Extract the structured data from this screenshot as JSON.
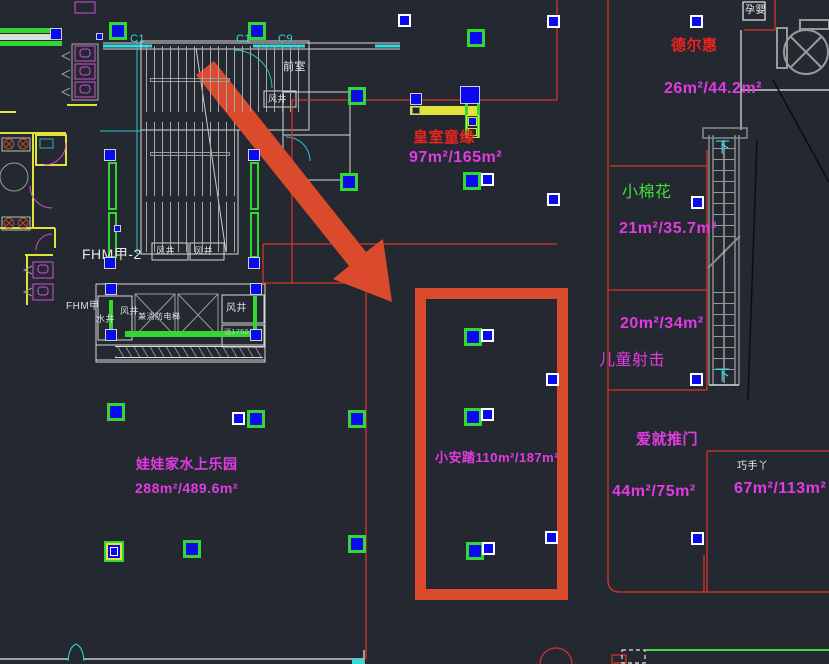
{
  "canvas": {
    "bg": "#232831",
    "width": 829,
    "height": 664
  },
  "palette": {
    "magenta": "#e13ce1",
    "red_text": "#ea241e",
    "green_text": "#3fdf3f",
    "cyan": "#35dcdc",
    "white": "#e8e8e8",
    "blue_marker": "#0a0af0",
    "green_marker": "#32d732",
    "highlight_orange": "#dc4a2e",
    "cad_red_line": "#d5352a",
    "yellow": "#e2e23c"
  },
  "stores": [
    {
      "name": "皇室童缘",
      "area": "97m²/165m²"
    },
    {
      "name": "德尔惠",
      "area": "26m²/44.2m²"
    },
    {
      "name": "小棉花",
      "area": "21m²/35.7m²"
    },
    {
      "name": "未命名铺位",
      "area": "20m²/34m²"
    },
    {
      "name": "儿童射击",
      "area": ""
    },
    {
      "name": "爱就推门",
      "area": "44m²/75m²"
    },
    {
      "name": "巧手丫",
      "area": "67m²/113m²"
    },
    {
      "name": "小安踏",
      "area": "110m²/187m²"
    },
    {
      "name": "娃娃家水上乐园",
      "area": "288m²/489.6m²"
    }
  ],
  "texts": [
    {
      "id": "front-room-label",
      "text": "前室",
      "x": 283,
      "y": 62,
      "s": 11,
      "c": "#e8e8e8"
    },
    {
      "id": "grid-c1-a",
      "text": "C1",
      "x": 130,
      "y": 34,
      "s": 11,
      "c": "#35dcdc"
    },
    {
      "id": "grid-c1-b",
      "text": "C1",
      "x": 236,
      "y": 34,
      "s": 11,
      "c": "#35dcdc"
    },
    {
      "id": "grid-c9",
      "text": "C9",
      "x": 278,
      "y": 34,
      "s": 11,
      "c": "#35dcdc"
    },
    {
      "id": "shaft-wind-top",
      "text": "风井",
      "x": 268,
      "y": 95,
      "s": 9,
      "c": "#dddddd"
    },
    {
      "id": "stair-tag-fhm",
      "text": "FHM甲-2",
      "x": 82,
      "y": 247,
      "s": 14,
      "c": "#e8e8e8"
    },
    {
      "id": "shaft-wind-1",
      "text": "风井",
      "x": 156,
      "y": 247,
      "s": 9,
      "c": "#dddddd"
    },
    {
      "id": "shaft-wind-2",
      "text": "风井",
      "x": 194,
      "y": 247,
      "s": 9,
      "c": "#dddddd"
    },
    {
      "id": "elevator-tag-fhm",
      "text": "FHM甲",
      "x": 66,
      "y": 302,
      "s": 10,
      "c": "#dddddd"
    },
    {
      "id": "shaft-water",
      "text": "水井",
      "x": 96,
      "y": 315,
      "s": 9,
      "c": "#dddddd"
    },
    {
      "id": "shaft-wind-3",
      "text": "风井",
      "x": 120,
      "y": 307,
      "s": 9,
      "c": "#dddddd"
    },
    {
      "id": "fire-elevator-label",
      "text": "兼消防电梯",
      "x": 138,
      "y": 313,
      "s": 8,
      "c": "#dddddd"
    },
    {
      "id": "shaft-wind-4",
      "text": "风井",
      "x": 226,
      "y": 304,
      "s": 10,
      "c": "#dddddd"
    },
    {
      "id": "fire-hydrant-note",
      "text": "消1750",
      "x": 224,
      "y": 329,
      "s": 7,
      "c": "#cccccc"
    },
    {
      "id": "store-name-huangshi",
      "text": "皇室童缘",
      "x": 413,
      "y": 130,
      "s": 15,
      "c": "#ea241e",
      "b": 1
    },
    {
      "id": "store-area-huangshi",
      "text": "97m²/165m²",
      "x": 409,
      "y": 150,
      "s": 16,
      "c": "#e13ce1",
      "b": 1
    },
    {
      "id": "infant-zone-label",
      "text": "孕婴",
      "x": 745,
      "y": 6,
      "s": 10,
      "c": "#eeeeee"
    },
    {
      "id": "store-name-deerhui",
      "text": "德尔惠",
      "x": 671,
      "y": 38,
      "s": 15,
      "c": "#ea241e",
      "b": 1
    },
    {
      "id": "store-area-deerhui",
      "text": "26m²/44.2m²",
      "x": 664,
      "y": 81,
      "s": 16,
      "c": "#e13ce1",
      "b": 1
    },
    {
      "id": "store-name-xiaomianhua",
      "text": "小棉花",
      "x": 622,
      "y": 185,
      "s": 16,
      "c": "#3fdf3f"
    },
    {
      "id": "store-area-xiaomianhua",
      "text": "21m²/35.7m²",
      "x": 619,
      "y": 221,
      "s": 16,
      "c": "#e13ce1",
      "b": 1
    },
    {
      "id": "store-area-2034",
      "text": "20m²/34m²",
      "x": 620,
      "y": 316,
      "s": 16,
      "c": "#e13ce1",
      "b": 1
    },
    {
      "id": "store-name-ertongsheji",
      "text": "儿童射击",
      "x": 599,
      "y": 353,
      "s": 16,
      "c": "#e13ce1"
    },
    {
      "id": "escalator-down-top",
      "text": "下",
      "x": 715,
      "y": 140,
      "s": 15,
      "c": "#35dcdc"
    },
    {
      "id": "escalator-down-bottom",
      "text": "下",
      "x": 715,
      "y": 368,
      "s": 15,
      "c": "#35dcdc"
    },
    {
      "id": "store-name-aijiutuimen",
      "text": "爱就推门",
      "x": 636,
      "y": 432,
      "s": 15,
      "c": "#e13ce1",
      "b": 1
    },
    {
      "id": "store-area-aijiutuimen",
      "text": "44m²/75m²",
      "x": 612,
      "y": 484,
      "s": 16,
      "c": "#e13ce1",
      "b": 1
    },
    {
      "id": "store-name-qiaoshouya",
      "text": "巧手丫",
      "x": 737,
      "y": 462,
      "s": 10,
      "c": "#eeeeee"
    },
    {
      "id": "store-area-qiaoshouya",
      "text": "67m²/113m²",
      "x": 734,
      "y": 481,
      "s": 16,
      "c": "#e13ce1",
      "b": 1
    },
    {
      "id": "store-label-xiaoanta",
      "text": "小安踏110m²/187m²",
      "x": 435,
      "y": 451,
      "s": 13,
      "c": "#e13ce1",
      "b": 1
    },
    {
      "id": "store-name-wawajia",
      "text": "娃娃家水上乐园",
      "x": 136,
      "y": 457,
      "s": 14,
      "c": "#e13ce1",
      "b": 1
    },
    {
      "id": "store-area-wawajia",
      "text": "288m²/489.6m²",
      "x": 135,
      "y": 481,
      "s": 14,
      "c": "#e13ce1",
      "b": 1
    }
  ],
  "markers": [
    {
      "t": "g",
      "x": 109,
      "y": 22
    },
    {
      "t": "g",
      "x": 248,
      "y": 22
    },
    {
      "t": "g",
      "x": 348,
      "y": 87
    },
    {
      "t": "g",
      "x": 467,
      "y": 29
    },
    {
      "t": "g",
      "x": 340,
      "y": 173
    },
    {
      "t": "g",
      "x": 463,
      "y": 172
    },
    {
      "t": "g",
      "x": 247,
      "y": 410
    },
    {
      "t": "g",
      "x": 348,
      "y": 410
    },
    {
      "t": "g",
      "x": 107,
      "y": 403
    },
    {
      "t": "g",
      "x": 183,
      "y": 540
    },
    {
      "t": "g",
      "x": 348,
      "y": 535
    },
    {
      "t": "g",
      "x": 464,
      "y": 328
    },
    {
      "t": "g",
      "x": 464,
      "y": 408
    },
    {
      "t": "g",
      "x": 466,
      "y": 542
    },
    {
      "t": "w",
      "x": 398,
      "y": 14
    },
    {
      "t": "w",
      "x": 547,
      "y": 15
    },
    {
      "t": "w",
      "x": 690,
      "y": 15
    },
    {
      "t": "w",
      "x": 481,
      "y": 173
    },
    {
      "t": "w",
      "x": 547,
      "y": 193
    },
    {
      "t": "w",
      "x": 691,
      "y": 196
    },
    {
      "t": "w",
      "x": 546,
      "y": 373
    },
    {
      "t": "w",
      "x": 690,
      "y": 373
    },
    {
      "t": "w",
      "x": 545,
      "y": 531
    },
    {
      "t": "w",
      "x": 691,
      "y": 532
    },
    {
      "t": "w",
      "x": 232,
      "y": 412
    },
    {
      "t": "w",
      "x": 481,
      "y": 329
    },
    {
      "t": "w",
      "x": 481,
      "y": 408
    },
    {
      "t": "w",
      "x": 482,
      "y": 542
    },
    {
      "t": "p",
      "x": 105,
      "y": 283
    },
    {
      "t": "p",
      "x": 250,
      "y": 283
    },
    {
      "t": "p",
      "x": 105,
      "y": 329
    },
    {
      "t": "p",
      "x": 250,
      "y": 329
    },
    {
      "t": "p",
      "x": 104,
      "y": 149
    },
    {
      "t": "p",
      "x": 104,
      "y": 257
    },
    {
      "t": "p",
      "x": 248,
      "y": 149
    },
    {
      "t": "p",
      "x": 248,
      "y": 257
    },
    {
      "t": "p",
      "x": 50,
      "y": 28
    },
    {
      "t": "p",
      "x": 410,
      "y": 93
    },
    {
      "t": "p",
      "x": 460,
      "y": 86,
      "w": 20,
      "h": 18
    },
    {
      "t": "s",
      "x": 96,
      "y": 33
    },
    {
      "t": "s",
      "x": 114,
      "y": 225
    },
    {
      "t": "gy",
      "x": 104,
      "y": 541
    }
  ],
  "highlight": {
    "note": "thick orange selection rectangle",
    "color": "#dc4a2e"
  },
  "arrow": {
    "note": "large orange pointer arrow",
    "color": "#dc4a2e"
  }
}
